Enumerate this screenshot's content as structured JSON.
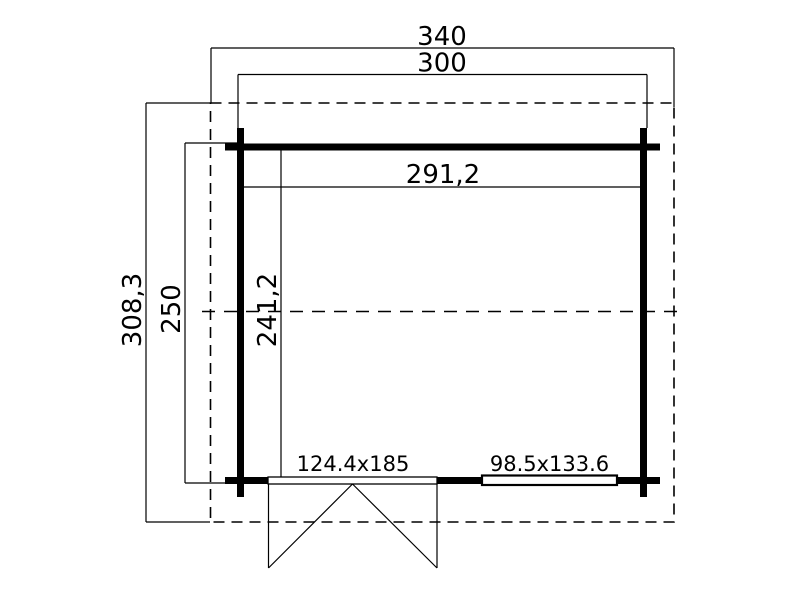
{
  "drawing": {
    "kind": "garden-house floor plan",
    "background_color": "#ffffff",
    "line_color": "#000000",
    "dimensions": {
      "outer_width": "340",
      "wall_outer_width": "300",
      "interior_width": "291,2",
      "outer_depth": "308,3",
      "wall_outer_depth": "250",
      "interior_depth": "241,2"
    },
    "openings": {
      "door_label": "124.4x185",
      "window_label": "98.5x133.6"
    }
  }
}
